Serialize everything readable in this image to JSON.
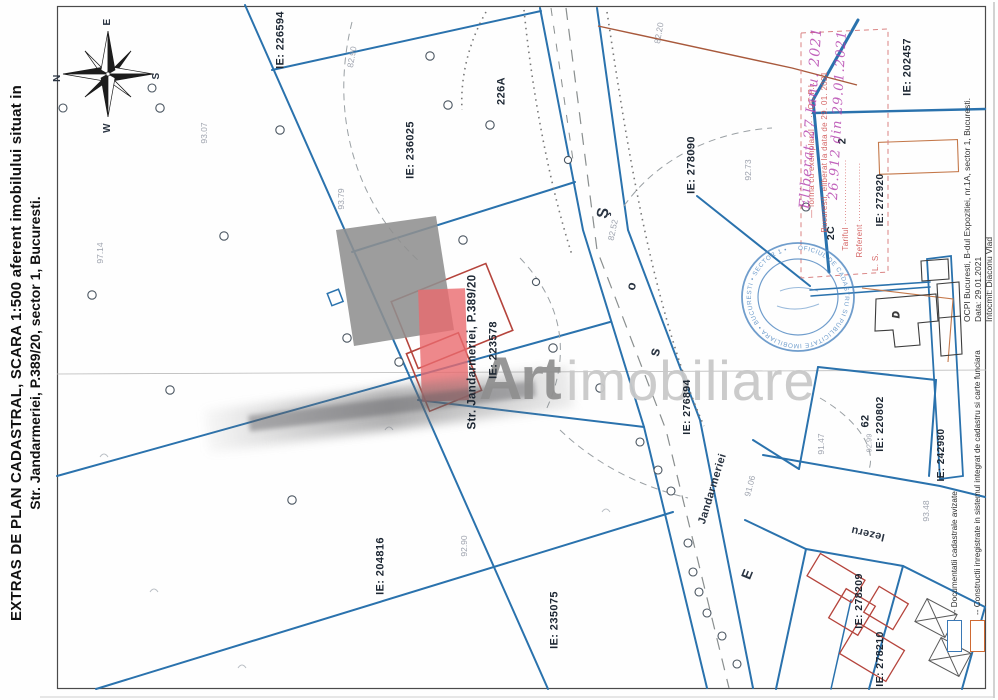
{
  "document": {
    "title_line1": "EXTRAS DE PLAN CADASTRAL, SCARA 1:500 aferent imobilului situat in",
    "title_line2": "Str. Jandarmeriei, P.389/20, sector 1, Bucuresti.",
    "issuer_line1": "OCPI Bucuresti, B-dul Expozitiei, nr.1A, sector 1, Bucuresti.",
    "issuer_line2": "Data: 29.01.2021",
    "issuer_line3": "Intocmit: Diaconu Vlad"
  },
  "legend": {
    "items": [
      {
        "label": "-- Documentatii cadastrale avizate",
        "color": "#3a78b5"
      },
      {
        "label": "-- Constructii inregistrate in sistemul integrat de cadastru si carte funciara",
        "color": "#cf6a33"
      }
    ]
  },
  "compass": {
    "north": "N",
    "east": "E",
    "south": "S",
    "west": "W"
  },
  "watermark": {
    "word1": "Art",
    "word2": "imobiliare"
  },
  "stamps": {
    "round_text": "OFICIUL DE CADASTRU SI PUBLICITATE IMOBILIARA • BUCURESTI • SECTOR 1 •",
    "red_stamp_lines": [
      "— forma cu exemplarul ·· ·· OC.P.I.",
      "Bucuresti, eliberat la data de 29. 01. 2021",
      "Tariful ··························",
      "Referent ························",
      "L. S."
    ],
    "handwriting_line1": "Eliberat 27 Ianu. 2021",
    "handwriting_line2": "26.912 din 29.01.2021"
  },
  "colors": {
    "parcel_line_blue": "#2a72ad",
    "building_red": "#b5443c",
    "legend_orange": "#cf6a33",
    "stamp_red": "#d15757",
    "stamp_blue": "#4d86c0",
    "handwriting_purple": "#b23cab",
    "watermark_red": "#ea6a6e",
    "watermark_gray": "#8f8f8f"
  },
  "map": {
    "labels": [
      {
        "name": "parcel-label-ie-226594",
        "text": "IE: 226594",
        "x": 281,
        "y": 40,
        "rot": -90,
        "fs": 11
      },
      {
        "name": "parcel-label-ie-236025",
        "text": "IE: 236025",
        "x": 411,
        "y": 150,
        "rot": -90,
        "fs": 11
      },
      {
        "name": "parcel-label-226a",
        "text": "226A",
        "x": 502,
        "y": 91,
        "rot": -90,
        "fs": 11
      },
      {
        "name": "parcel-label-ie-278090",
        "text": "IE: 278090",
        "x": 692,
        "y": 165,
        "rot": -90,
        "fs": 11
      },
      {
        "name": "parcel-label-ie-202457",
        "text": "IE: 202457",
        "x": 908,
        "y": 67,
        "rot": -90,
        "fs": 11
      },
      {
        "name": "parcel-label-2",
        "text": "2",
        "x": 843,
        "y": 141,
        "rot": -90,
        "fs": 11
      },
      {
        "name": "parcel-label-2c",
        "text": "2C",
        "x": 831,
        "y": 233,
        "rot": -90,
        "fs": 10.5
      },
      {
        "name": "parcel-label-ie-272920",
        "text": "IE: 272920",
        "x": 881,
        "y": 200,
        "rot": -90,
        "fs": 10
      },
      {
        "name": "site-address-label",
        "text": "Str. Jandarmeriei, P.389/20",
        "x": 473,
        "y": 352,
        "rot": -90,
        "fs": 11.5
      },
      {
        "name": "parcel-label-ie-223578",
        "text": "IE: 223578",
        "x": 494,
        "y": 350,
        "rot": -90,
        "fs": 11
      },
      {
        "name": "parcel-label-ie-276894",
        "text": "IE: 276894",
        "x": 687,
        "y": 407,
        "rot": -90,
        "fs": 10.5
      },
      {
        "name": "parcel-label-ie-204816",
        "text": "IE: 204816",
        "x": 381,
        "y": 566,
        "rot": -90,
        "fs": 11
      },
      {
        "name": "parcel-label-ie-235075",
        "text": "IE: 235075",
        "x": 555,
        "y": 620,
        "rot": -90,
        "fs": 11
      },
      {
        "name": "parcel-label-62",
        "text": "62",
        "x": 866,
        "y": 421,
        "rot": -90,
        "fs": 11
      },
      {
        "name": "parcel-label-ie-220802",
        "text": "IE: 220802",
        "x": 880,
        "y": 424,
        "rot": -90,
        "fs": 10.5
      },
      {
        "name": "parcel-label-ie-242980",
        "text": "IE: 242980",
        "x": 942,
        "y": 455,
        "rot": -90,
        "fs": 10
      },
      {
        "name": "street-label-iezeru",
        "text": "Iezeru",
        "x": 868,
        "y": 533,
        "rot": 193,
        "fs": 11,
        "cls": "soft"
      },
      {
        "name": "parcel-label-ie-278209",
        "text": "IE: 278209",
        "x": 859,
        "y": 601,
        "rot": -90,
        "fs": 10.5
      },
      {
        "name": "parcel-label-ie-278210",
        "text": "IE: 278210",
        "x": 880,
        "y": 659,
        "rot": -90,
        "fs": 10.5
      },
      {
        "name": "road-letter",
        "text": "Ş",
        "x": 604,
        "y": 213,
        "rot": -78,
        "fs": 16,
        "cls": "road"
      },
      {
        "name": "road-letter",
        "text": "o",
        "x": 631,
        "y": 286,
        "rot": -76,
        "fs": 13,
        "cls": "road"
      },
      {
        "name": "road-letter",
        "text": "s",
        "x": 655,
        "y": 352,
        "rot": -75,
        "fs": 15,
        "cls": "road"
      },
      {
        "name": "road-name",
        "text": "Jandarmeriei",
        "x": 713,
        "y": 489,
        "rot": -73,
        "fs": 11,
        "cls": "road"
      },
      {
        "name": "road-letter",
        "text": "E",
        "x": 747,
        "y": 574,
        "rot": -68,
        "fs": 14,
        "cls": "road"
      },
      {
        "name": "elevation-mark",
        "text": "97.14",
        "x": 100,
        "y": 253,
        "rot": -90,
        "fs": 8.5,
        "cls": "elev"
      },
      {
        "name": "elevation-mark",
        "text": "93.07",
        "x": 204,
        "y": 133,
        "rot": -90,
        "fs": 8.5,
        "cls": "elev"
      },
      {
        "name": "elevation-mark",
        "text": "93.79",
        "x": 341,
        "y": 199,
        "rot": -90,
        "fs": 8.5,
        "cls": "elev"
      },
      {
        "name": "elevation-mark",
        "text": "82.90",
        "x": 352,
        "y": 57,
        "rot": -80,
        "fs": 8.5,
        "cls": "elev"
      },
      {
        "name": "elevation-mark",
        "text": "82.52",
        "x": 613,
        "y": 230,
        "rot": -78,
        "fs": 8.5,
        "cls": "elev"
      },
      {
        "name": "elevation-mark",
        "text": "82.20",
        "x": 659,
        "y": 33,
        "rot": -80,
        "fs": 8.5,
        "cls": "elev"
      },
      {
        "name": "elevation-mark",
        "text": "92.73",
        "x": 748,
        "y": 170,
        "rot": -90,
        "fs": 8.5,
        "cls": "elev"
      },
      {
        "name": "elevation-mark",
        "text": "92.90",
        "x": 464,
        "y": 546,
        "rot": -90,
        "fs": 8.5,
        "cls": "elev"
      },
      {
        "name": "elevation-mark",
        "text": "91.06",
        "x": 750,
        "y": 486,
        "rot": -75,
        "fs": 8.5,
        "cls": "elev"
      },
      {
        "name": "elevation-mark",
        "text": "91.47",
        "x": 821,
        "y": 444,
        "rot": -90,
        "fs": 8.5,
        "cls": "elev"
      },
      {
        "name": "elevation-mark",
        "text": "93.48",
        "x": 926,
        "y": 511,
        "rot": -90,
        "fs": 8.5,
        "cls": "elev"
      },
      {
        "name": "elevation-mark",
        "text": "92.99",
        "x": 869,
        "y": 443,
        "rot": -90,
        "fs": 7.5,
        "cls": "elev"
      },
      {
        "name": "red-stamp-text-line",
        "text": "— forma cu exemplarul ·· ·· OC.P.I.",
        "x": 812,
        "y": 150,
        "rot": -90,
        "fs": 8,
        "cls": "stamp-red"
      },
      {
        "name": "red-stamp-text-line",
        "text": "Bucuresti, eliberat la data de 29. 01. 2021",
        "x": 825,
        "y": 152,
        "rot": -90,
        "fs": 8,
        "cls": "stamp-red"
      },
      {
        "name": "red-stamp-text-line",
        "text": "Tariful ······················",
        "x": 846,
        "y": 205,
        "rot": -90,
        "fs": 8,
        "cls": "stamp-red"
      },
      {
        "name": "red-stamp-text-line",
        "text": "Referent ····················",
        "x": 860,
        "y": 210,
        "rot": -90,
        "fs": 8,
        "cls": "stamp-red"
      },
      {
        "name": "red-stamp-text-line",
        "text": "L. S.",
        "x": 876,
        "y": 262,
        "rot": -90,
        "fs": 8,
        "cls": "stamp-red"
      },
      {
        "name": "handwriting-note",
        "text": "Eliberat 27 Ianu. 2021",
        "x": 811,
        "y": 118,
        "rot": -86,
        "fs": 14,
        "cls": "hw"
      },
      {
        "name": "handwriting-note",
        "text": "26.912 din 29.01.2021",
        "x": 838,
        "y": 115,
        "rot": -87,
        "fs": 13,
        "cls": "hw"
      },
      {
        "name": "compass-label-e",
        "text": "E",
        "x": 108,
        "y": 22,
        "rot": -90,
        "fs": 10,
        "cls": "soft"
      },
      {
        "name": "compass-label-n",
        "text": "N",
        "x": 58,
        "y": 78,
        "rot": -90,
        "fs": 10,
        "cls": "soft"
      },
      {
        "name": "compass-label-s",
        "text": "S",
        "x": 157,
        "y": 76,
        "rot": -90,
        "fs": 10,
        "cls": "soft"
      },
      {
        "name": "compass-label-w",
        "text": "W",
        "x": 108,
        "y": 128,
        "rot": -90,
        "fs": 10,
        "cls": "soft"
      }
    ]
  }
}
